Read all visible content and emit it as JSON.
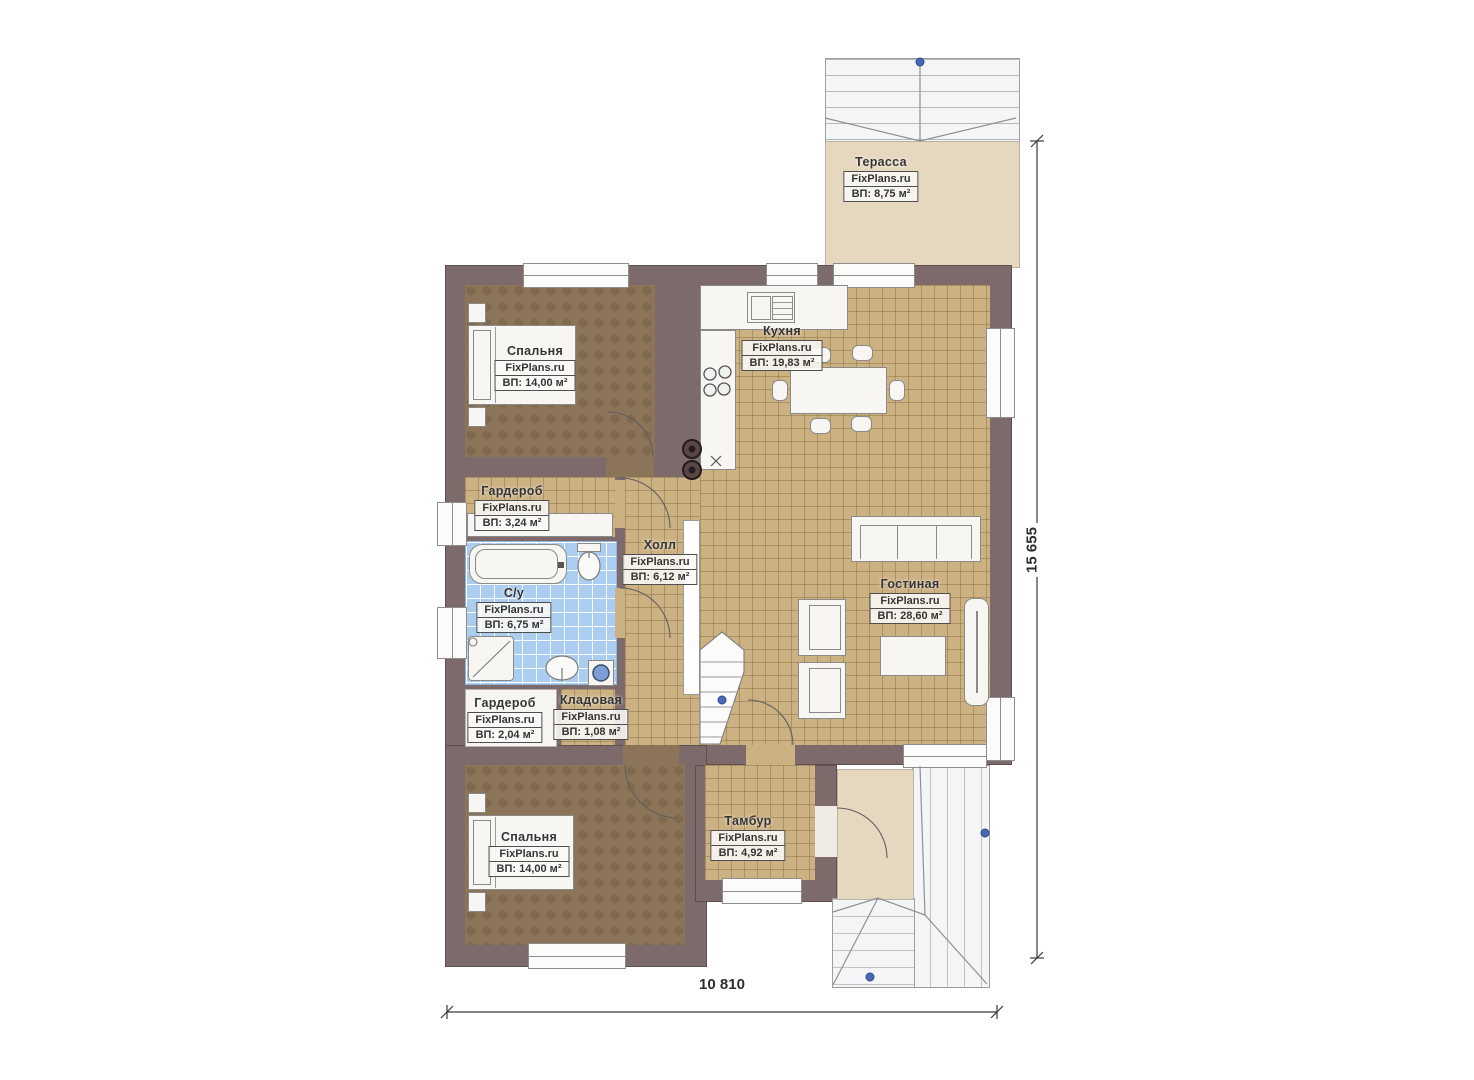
{
  "plan": {
    "watermark": "FixPlans.ru",
    "rooms": [
      {
        "id": "terrace",
        "name": "Терасса",
        "area": "ВП: 8,75 м²"
      },
      {
        "id": "bedroom-top",
        "name": "Спальня",
        "area": "ВП: 14,00 м²"
      },
      {
        "id": "kitchen",
        "name": "Кухня",
        "area": "ВП: 19,83 м²"
      },
      {
        "id": "wardrobe-top",
        "name": "Гардероб",
        "area": "ВП: 3,24 м²"
      },
      {
        "id": "hall",
        "name": "Холл",
        "area": "ВП: 6,12 м²"
      },
      {
        "id": "bathroom",
        "name": "С/у",
        "area": "ВП: 6,75 м²"
      },
      {
        "id": "living-room",
        "name": "Гостиная",
        "area": "ВП: 28,60 м²"
      },
      {
        "id": "wardrobe-bottom",
        "name": "Гардероб",
        "area": "ВП: 2,04 м²"
      },
      {
        "id": "storage",
        "name": "Кладовая",
        "area": "ВП: 1,08 м²"
      },
      {
        "id": "bedroom-bottom",
        "name": "Спальня",
        "area": "ВП: 14,00 м²"
      },
      {
        "id": "vestibule",
        "name": "Тамбур",
        "area": "ВП: 4,92 м²"
      }
    ],
    "dimensions": {
      "overall_width": "10 810",
      "overall_height": "15 655"
    },
    "colors": {
      "wall": "#7d6a6b",
      "tile_tan": "#ccb183",
      "floor_dark": "#8b7457",
      "tile_blue": "#abcdf0",
      "terrace_beige": "#e6d7bf",
      "grip_blue": "#4a69b5"
    }
  }
}
